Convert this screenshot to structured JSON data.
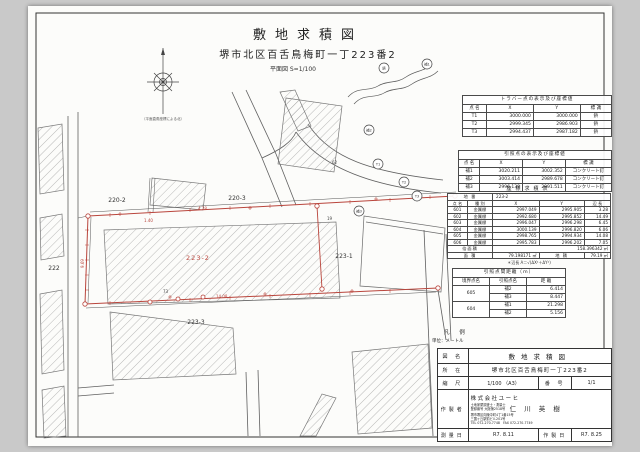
{
  "page": {
    "title": "敷地求積図",
    "subtitle": "堺市北区百舌鳥梅町一丁223番2",
    "scale_note": "平面図 S=1/100",
    "compass_caption": "（平面直角座標による北）"
  },
  "traverse_table": {
    "title": "トラバー点の表示及び座標値",
    "headers": [
      "点 名",
      "X",
      "Y",
      "標 識"
    ],
    "rows": [
      [
        "T1",
        "3000.000",
        "3000.000",
        "鋲"
      ],
      [
        "T2",
        "2999.345",
        "2986.903",
        "鋲"
      ],
      [
        "T3",
        "2994.437",
        "2987.182",
        "鋲"
      ]
    ]
  },
  "reference_table": {
    "title": "引照点の表示及び座標値",
    "headers": [
      "点 名",
      "X",
      "Y",
      "標 識"
    ],
    "rows": [
      [
        "補1",
        "3020.211",
        "3002.352",
        "コンクリート釘"
      ],
      [
        "補2",
        "3003.414",
        "2989.678",
        "コンクリート釘"
      ],
      [
        "補3",
        "2996.138",
        "2991.511",
        "コンクリート釘"
      ]
    ]
  },
  "area_table": {
    "title": "座標求積表",
    "lot_label": "地 番",
    "lot_value": "223-2",
    "headers": [
      "点 名",
      "種 別",
      "X",
      "Y",
      "辺 長"
    ],
    "rows": [
      [
        "601",
        "金属標",
        "2997.049",
        "2995.905",
        "3.28"
      ],
      [
        "602",
        "金属標",
        "2992.680",
        "2995.852",
        "14.49"
      ],
      [
        "603",
        "金属標",
        "2996.047",
        "2996.298",
        "6.45"
      ],
      [
        "604",
        "金属標",
        "3000.139",
        "2996.820",
        "6.06"
      ],
      [
        "605",
        "金属標",
        "2998.765",
        "2994.934",
        "14.08"
      ],
      [
        "606",
        "金属標",
        "2995.783",
        "2996.202",
        "7.05"
      ]
    ],
    "double_area_label": "倍面積",
    "double_area": "158.396342 ㎡",
    "area_label": "面 積",
    "area": "79.198171 ㎡",
    "chiseki_label": "地 積",
    "chiseki": "79.19 ㎡",
    "note": "＊辺長 A＝√(ΔX²＋ΔY²)"
  },
  "distance_table": {
    "title": "引照点間距離（ｍ）",
    "headers": [
      "境界点名",
      "引照点名",
      "距 離"
    ],
    "rows": [
      [
        "605",
        "補2",
        "6.414"
      ],
      [
        "",
        "補3",
        "8.447"
      ],
      [
        "604",
        "補1",
        "21.298"
      ],
      [
        "",
        "補2",
        "5.156"
      ]
    ]
  },
  "legend": {
    "title": "凡 例",
    "unit": "単位：メートル"
  },
  "title_block": {
    "zumei_label": "図 名",
    "zumei": "敷地求積図",
    "shozai_label": "所 在",
    "shozai": "堺市北区百舌鳥梅町一丁223番2",
    "scale_label": "縮 尺",
    "scale": "1/100 （A3）",
    "number_label": "番 号",
    "number": "1/1",
    "author_label": "作製者",
    "company": "株式会社ユーヒ",
    "qual1": "土地家屋調査士",
    "qual2": "測量士",
    "reg": "登録番号 大阪第2518号",
    "name": "仁 川 英 樹",
    "address1": "堺市堺区向陵中町4丁1番15号",
    "address2": "三国ヶ丘駅前ビル201号",
    "tel": "TEL 072-270-7748　FAX 072-270-7749",
    "survey_date_label": "測量日",
    "survey_date": "R7. 8.11",
    "made_date_label": "作製日",
    "made_date": "R7. 8.25"
  },
  "drawing": {
    "lots": [
      "220-2",
      "220-3",
      "222",
      "223-2",
      "223-1",
      "223-3"
    ],
    "dims": [
      "4.28",
      "1.40",
      "9.69",
      "14.08",
      "62",
      "19",
      "73"
    ],
    "markers": [
      "補1",
      "鋲",
      "補2",
      "T1",
      "T2",
      "T3",
      "補3"
    ],
    "red_color": "#b9453c"
  }
}
